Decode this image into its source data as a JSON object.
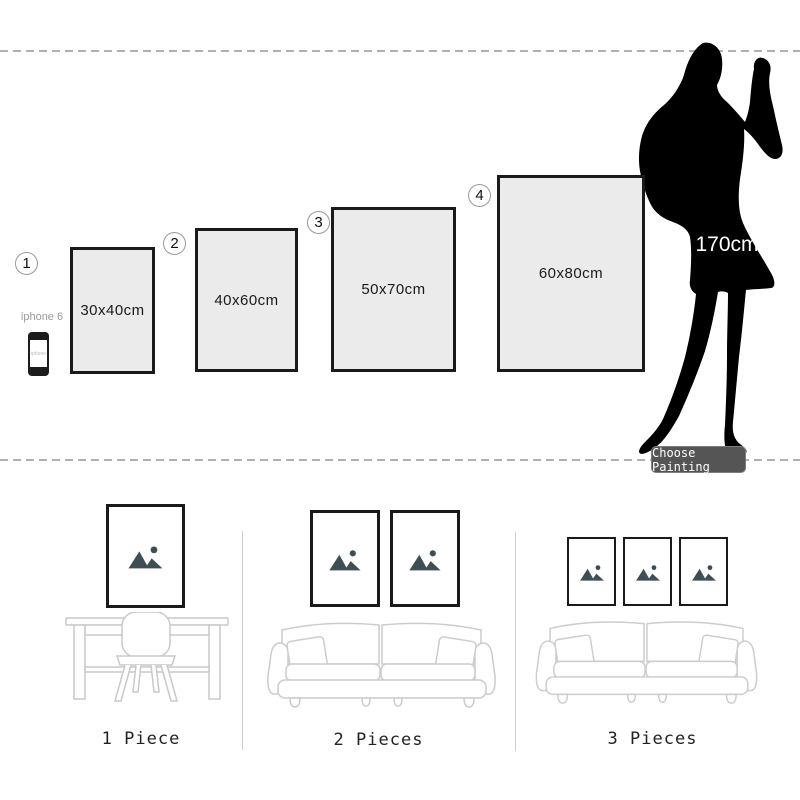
{
  "top": {
    "sizes": [
      {
        "num": "1",
        "label": "30x40cm"
      },
      {
        "num": "2",
        "label": "40x60cm"
      },
      {
        "num": "3",
        "label": "50x70cm"
      },
      {
        "num": "4",
        "label": "60x80cm"
      }
    ],
    "phone": {
      "label": "iphone 6",
      "screen_text": "iphone"
    },
    "person": {
      "height": "170cm"
    },
    "button": {
      "label": "Choose Painting"
    }
  },
  "bottom": {
    "scenes": [
      {
        "label": "1 Piece"
      },
      {
        "label": "2 Pieces"
      },
      {
        "label": "3 Pieces"
      }
    ]
  },
  "colors": {
    "frame_fill": "#ebebeb",
    "frame_border": "#1a1a1a",
    "silhouette": "#000000",
    "button_bg": "#555555",
    "button_text": "#ffffff",
    "line_art": "#cccccc",
    "placeholder_icon": "#3f4e54",
    "dashed_line": "#b0b0b0"
  }
}
